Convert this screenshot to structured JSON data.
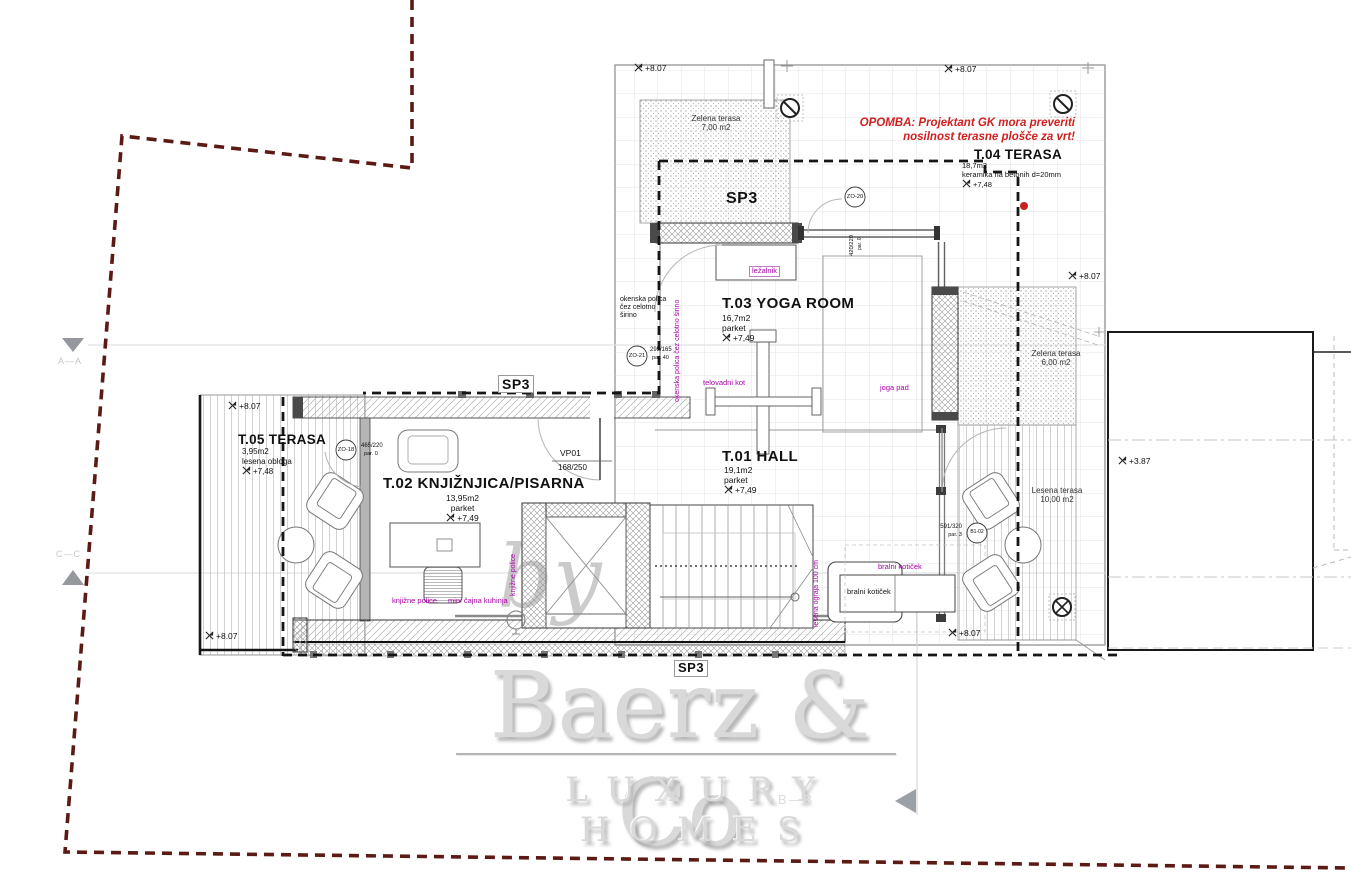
{
  "watermark": {
    "by": "by",
    "name": "Baerz & Co",
    "tagline": "LUXURY HOMES"
  },
  "note": {
    "line1": "OPOMBA: Projektant GK mora preveriti",
    "line2": "nosilnost terasne plošče za vrt!"
  },
  "rooms": {
    "t01": {
      "name": "T.01 HALL",
      "area": "19,1m2",
      "floor": "parket",
      "level": "+7,49"
    },
    "t02": {
      "name": "T.02 KNJIŽNJICA/PISARNA",
      "area": "13,95m2",
      "floor": "parket",
      "level": "+7,49"
    },
    "t03": {
      "name": "T.03 YOGA ROOM",
      "area": "16,7m2",
      "floor": "parket",
      "level": "+7,49"
    },
    "t04": {
      "name": "T.04 TERASA",
      "area": "18,7m2",
      "floor": "keramika na betonih d=20mm",
      "level": "+7,48"
    },
    "t05": {
      "name": "T.05 TERASA",
      "area": "3,95m2",
      "floor": "lesena obloga",
      "level": "+7,48"
    }
  },
  "areas": {
    "green_top": {
      "name": "Zelena terasa",
      "area": "7,00 m2"
    },
    "green_right": {
      "name": "Zelena terasa",
      "area": "6,00 m2"
    },
    "wood_right": {
      "name": "Lesena terasa",
      "area": "10,00 m2"
    }
  },
  "sp3": "SP3",
  "door": {
    "code": "VP01",
    "size": "168/250"
  },
  "windows": {
    "zo20": {
      "code": "ZO-20",
      "size": "420/220",
      "parapet": "par. 0"
    },
    "zo21": {
      "code": "ZO-21",
      "size": "295/165",
      "parapet": "par. 40"
    },
    "zo18": {
      "code": "ZO-18",
      "size": "465/220",
      "parapet": "par. 0"
    },
    "b102": {
      "code": "B1-02",
      "size": "591/320",
      "parapet": "par. 3"
    }
  },
  "labels": {
    "lezalnik": "ležalnik",
    "telovadni_kot": "telovadni kot",
    "joga_pad": "joga pad",
    "bralni_koticek": "bralni kotiček",
    "knjizne_police": "knjižne police",
    "mini_cajna_kuhinja": "mini čajna kuhinja",
    "okenska_1": "okenska polica",
    "okenska_2": "čez celotno",
    "okenska_3": "širino",
    "okenska_full": "okenska polica čez celotno širino",
    "ograja": "lesena ograja 100 cm"
  },
  "elevations": {
    "e807": "+8.07",
    "e387": "+3.87"
  },
  "sections": {
    "aa": "A—A",
    "bb": "B—B",
    "cc": "C—C"
  },
  "colors": {
    "accent_purple": "#a800a8",
    "note_red": "#cf1f1f",
    "boundary_red": "#5c1a14"
  }
}
